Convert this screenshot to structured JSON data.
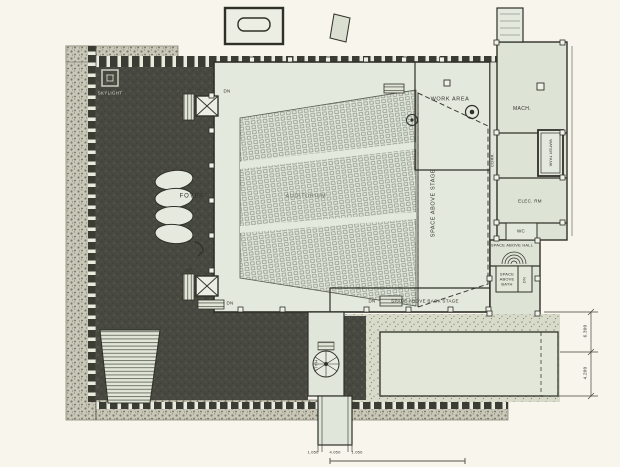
{
  "plan": {
    "rooms": {
      "skylight": "SKYLIGHT",
      "foyer": "FOYER",
      "auditorium": "AUDITORIUM",
      "space_above_stage": "SPACE ABOVE STAGE",
      "work_area": "WORK AREA",
      "corridor": "CORR.",
      "machine_room": "MACH.",
      "water_tank": "WATER TANK",
      "electrical_room": "ELEC. RM",
      "wc": "WC",
      "space_above_hall": "SPACE ABOVE HALL",
      "space_above_bath": "SPACE\nABOVE\nBATH",
      "space_above_back_stage": "SPACE ABOVE BACK STAGE",
      "hall": "HALL"
    },
    "stairs": {
      "dn_top": "DN",
      "up_bottom": "UP",
      "dn_bottom": "DN",
      "dn_pit": "DN",
      "dn_bath": "DN"
    },
    "dimensions": {
      "right_upper": "6.300",
      "right_lower": "4.200",
      "bottom_left": "1.050",
      "bottom_center": "4.050",
      "bottom_right": "1.050"
    },
    "colors": {
      "paper": "#f7f5ec",
      "floor": "#e4e9dd",
      "roof_dark": "#474840",
      "stone": "#c9c7b8",
      "line": "#2f3028"
    }
  }
}
